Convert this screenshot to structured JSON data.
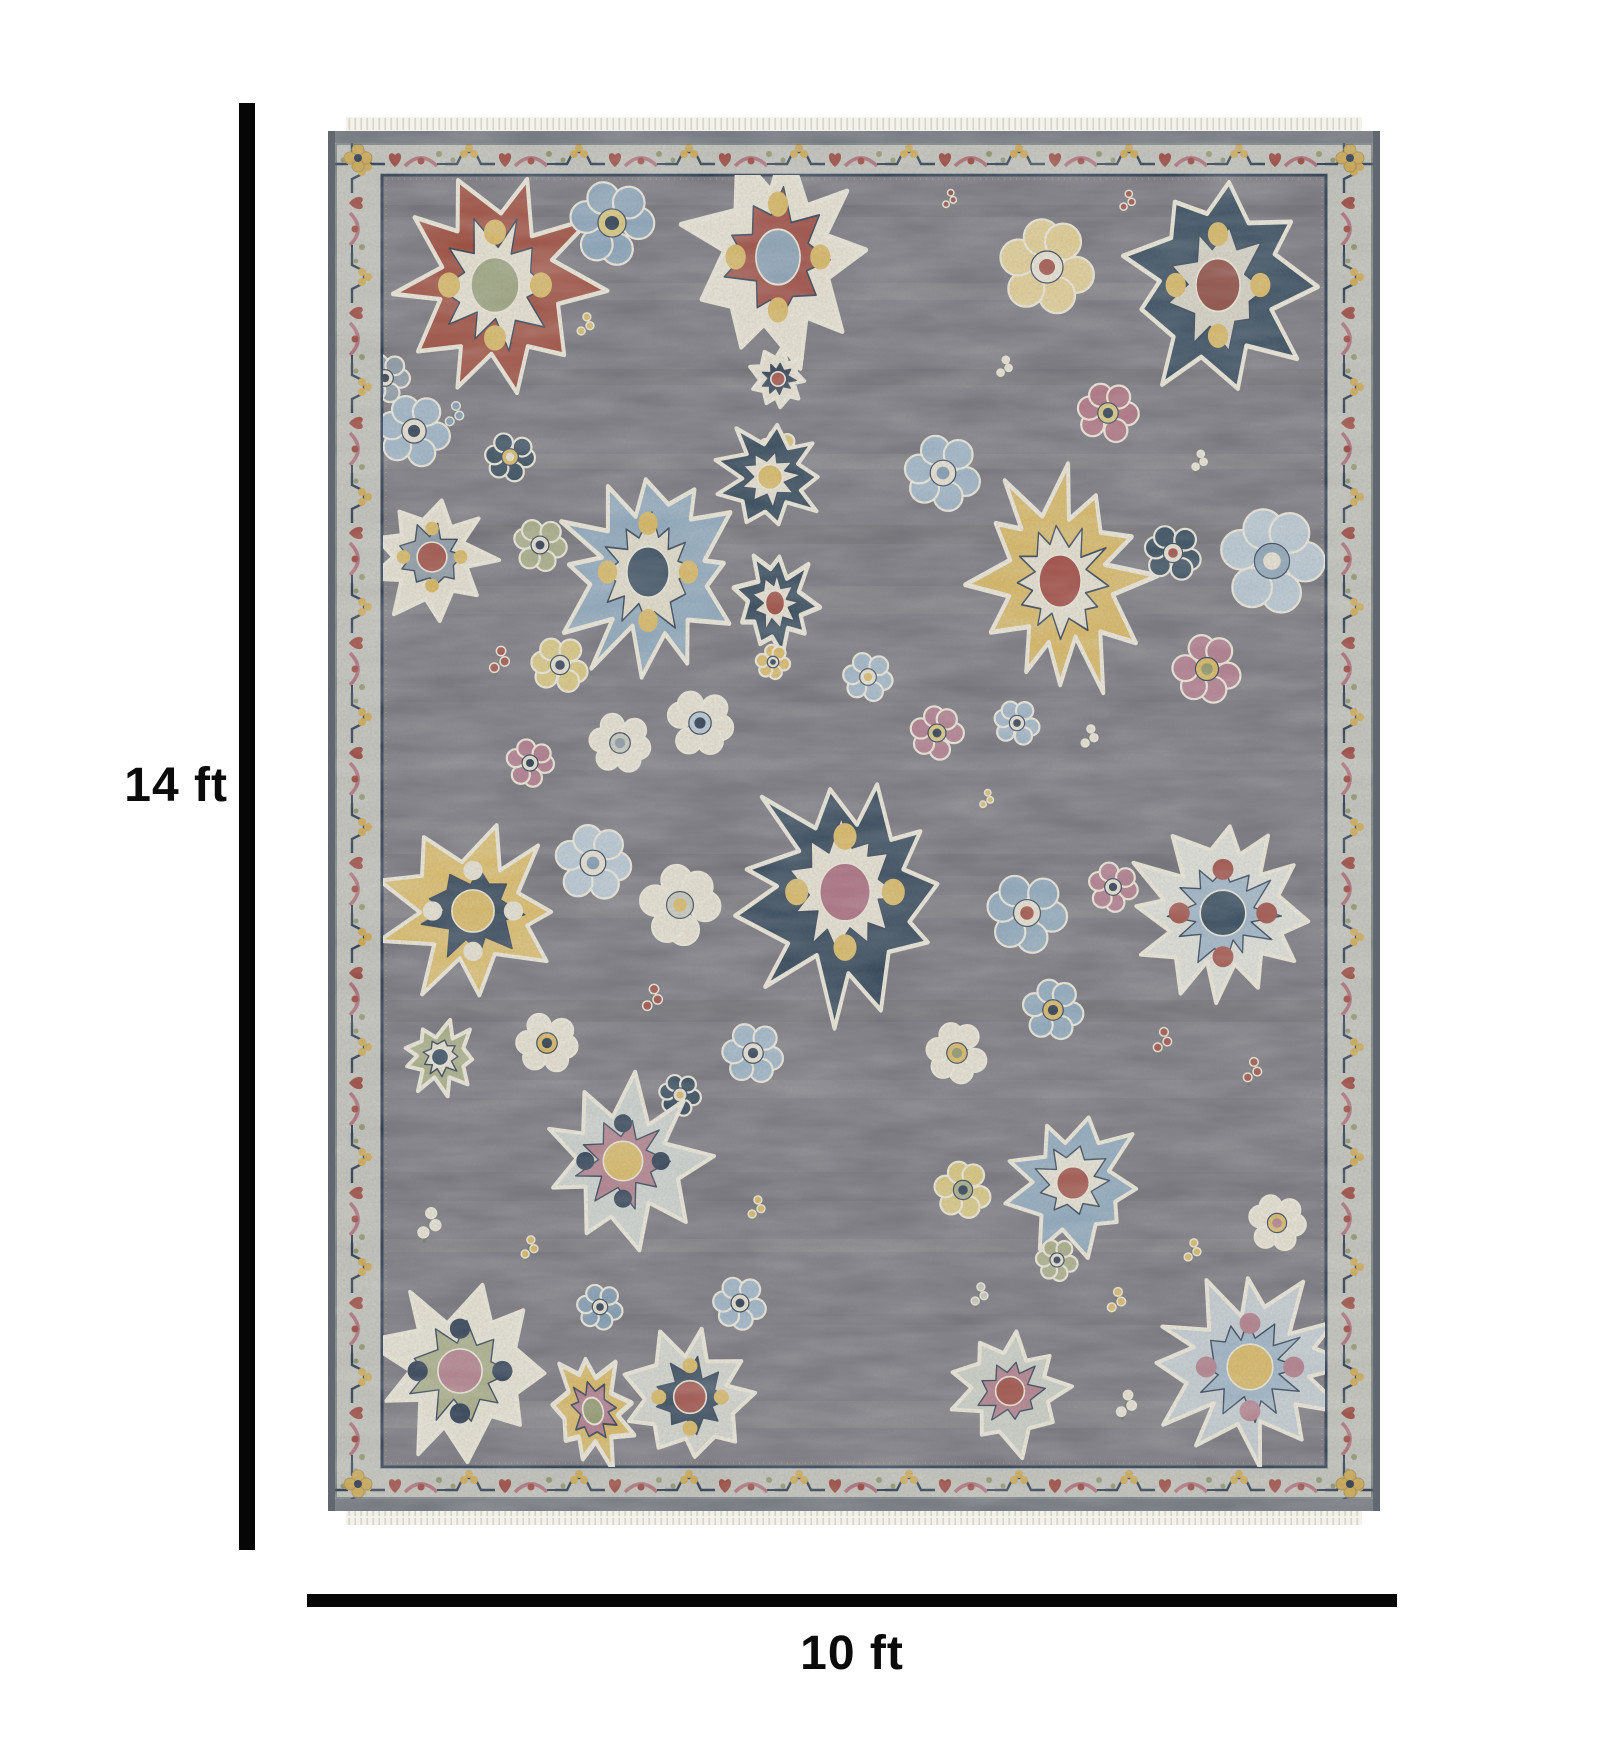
{
  "dimensions": {
    "height_label": "14 ft",
    "width_label": "10 ft"
  },
  "dimension_line_color": "#060606",
  "rug": {
    "fringe_color": "#f4f2ec",
    "fringe_tooth_color": "#d8d5c8",
    "selvedge_color": "#6e747b",
    "border_band_color": "#c2c3bb",
    "border_outline_color": "#4a5560",
    "guard_line_color": "#24364c",
    "guard_pin_color": "#c9b06a",
    "field_color": "#75747b",
    "motif_outline_ivory": "#ece8d8",
    "vine_colors": {
      "navy": "#24364c",
      "gold": "#cfa94e",
      "red": "#9a4036",
      "rose": "#ae6b77",
      "sage": "#8e9668"
    },
    "motifs": [
      {
        "t": "med",
        "x": 167,
        "y": 168,
        "r": 100,
        "sy": 1.15,
        "n": 10,
        "sd": 3,
        "o": "#9e4939",
        "i": "#e8e3d1",
        "c": "#9aa27a",
        "a": "#d9b85f"
      },
      {
        "t": "flw",
        "x": 284,
        "y": 106,
        "r": 44,
        "sd": 4,
        "o": "#89a4ba",
        "i": "#d9c77a",
        "c": "#24364c"
      },
      {
        "t": "spr",
        "x": 258,
        "y": 210,
        "r": 22,
        "sd": 5,
        "o": "#d9b85f"
      },
      {
        "t": "med",
        "x": 450,
        "y": 140,
        "r": 92,
        "sy": 1.25,
        "sd": 6,
        "o": "#e9e4d3",
        "i": "#9e4a3f",
        "c": "#8ba3b6",
        "a": "#d9b85f"
      },
      {
        "t": "med",
        "x": 450,
        "y": 262,
        "r": 30,
        "sd": 7,
        "o": "#e7e2d1",
        "i": "#24364c",
        "c": "#9e4a3f"
      },
      {
        "t": "flw",
        "x": 450,
        "y": 332,
        "r": 20,
        "sd": 8,
        "o": "#d9c77a",
        "i": "#e7e2d1",
        "c": "#24364c"
      },
      {
        "t": "flw",
        "x": 719,
        "y": 150,
        "r": 50,
        "sd": 9,
        "o": "#e3cf92",
        "i": "#e9e4d4",
        "c": "#9e4a3f"
      },
      {
        "t": "spr",
        "x": 800,
        "y": 86,
        "r": 20,
        "sd": 10,
        "o": "#9d4a41"
      },
      {
        "t": "med",
        "x": 890,
        "y": 168,
        "r": 92,
        "sy": 1.2,
        "sd": 11,
        "o": "#2d4457",
        "i": "#d7d3c4",
        "c": "#8e4a3f",
        "a": "#d9b85f"
      },
      {
        "t": "spr",
        "x": 622,
        "y": 84,
        "r": 18,
        "sd": 12,
        "o": "#8e4a3f"
      },
      {
        "t": "flw",
        "x": 780,
        "y": 296,
        "r": 32,
        "sd": 13,
        "o": "#ad6c7c",
        "i": "#d9c77a",
        "c": "#24364c"
      },
      {
        "t": "spr",
        "x": 677,
        "y": 252,
        "r": 20,
        "sd": 14,
        "o": "#e7e2d1"
      },
      {
        "t": "spr",
        "x": 127,
        "y": 300,
        "r": 24,
        "sd": 15,
        "o": "#7e9ab0"
      },
      {
        "t": "flw",
        "x": 86,
        "y": 314,
        "r": 38,
        "sd": 16,
        "o": "#9db4c6",
        "i": "#e7e2d1",
        "c": "#24364c"
      },
      {
        "t": "flw",
        "x": 57,
        "y": 261,
        "r": 26,
        "sd": 74,
        "o": "#8a98a3",
        "i": "#e7e2d1",
        "c": "#24364c"
      },
      {
        "t": "flw",
        "x": 182,
        "y": 340,
        "r": 26,
        "sd": 17,
        "o": "#2d4457",
        "i": "#d9b85f",
        "c": "#e7e2d1"
      },
      {
        "t": "med",
        "x": 104,
        "y": 440,
        "r": 62,
        "sd": 18,
        "o": "#e6e1d0",
        "i": "#8a98a3",
        "c": "#9e4a3f",
        "a": "#d9b85f"
      },
      {
        "t": "flw",
        "x": 212,
        "y": 428,
        "r": 28,
        "sd": 19,
        "o": "#a8ad85",
        "i": "#e7e2d1",
        "c": "#24364c"
      },
      {
        "t": "med",
        "x": 320,
        "y": 455,
        "r": 88,
        "sy": 1.2,
        "n": 12,
        "sd": 20,
        "o": "#8da8bc",
        "i": "#e2ddc9",
        "c": "#2d4457",
        "a": "#d9b85f"
      },
      {
        "t": "med",
        "x": 442,
        "y": 360,
        "r": 52,
        "sd": 21,
        "o": "#2c4254",
        "i": "#e7e2d0",
        "c": "#d9b85f"
      },
      {
        "t": "med",
        "x": 447,
        "y": 486,
        "r": 40,
        "sy": 1.3,
        "sd": 22,
        "o": "#2c4254",
        "i": "#e7e2d1",
        "c": "#9e4a3f"
      },
      {
        "t": "med",
        "x": 732,
        "y": 464,
        "r": 88,
        "sy": 1.25,
        "n": 12,
        "sd": 23,
        "o": "#d9b860",
        "i": "#e6e1cf",
        "c": "#9d4036"
      },
      {
        "t": "flw",
        "x": 615,
        "y": 356,
        "r": 40,
        "sd": 24,
        "o": "#9db4c6",
        "i": "#e7e2d1",
        "c": "#7e9ab0"
      },
      {
        "t": "flw",
        "x": 845,
        "y": 436,
        "r": 30,
        "sd": 25,
        "o": "#2d4457",
        "i": "#e7e2d1",
        "c": "#9e4a3f"
      },
      {
        "t": "flw",
        "x": 944,
        "y": 444,
        "r": 55,
        "sd": 26,
        "o": "#b9c9d4",
        "i": "#8aa3b6",
        "c": "#e7e2d1"
      },
      {
        "t": "spr",
        "x": 872,
        "y": 346,
        "r": 20,
        "sd": 27,
        "o": "#e7e2d1"
      },
      {
        "t": "spr",
        "x": 172,
        "y": 546,
        "r": 26,
        "sd": 28,
        "o": "#9e4a3f"
      },
      {
        "t": "flw",
        "x": 232,
        "y": 548,
        "r": 30,
        "sd": 29,
        "o": "#d9c77a",
        "i": "#e7e2d1",
        "c": "#24364c"
      },
      {
        "t": "flw",
        "x": 292,
        "y": 626,
        "r": 32,
        "sd": 30,
        "o": "#e7e2d1",
        "i": "#c6c9bd",
        "c": "#8a98a3"
      },
      {
        "t": "flw",
        "x": 372,
        "y": 606,
        "r": 35,
        "sd": 31,
        "o": "#e7e2d1",
        "i": "#b9c9d4",
        "c": "#24364c"
      },
      {
        "t": "flw",
        "x": 202,
        "y": 646,
        "r": 25,
        "sd": 32,
        "o": "#b0798a",
        "i": "#e7e2d1",
        "c": "#24364c"
      },
      {
        "t": "flw",
        "x": 609,
        "y": 616,
        "r": 28,
        "sd": 33,
        "o": "#b0798a",
        "i": "#d9c77a",
        "c": "#24364c"
      },
      {
        "t": "flw",
        "x": 879,
        "y": 552,
        "r": 36,
        "sd": 34,
        "o": "#b0798a",
        "i": "#d9b85f",
        "c": "#8e9668"
      },
      {
        "t": "spr",
        "x": 762,
        "y": 622,
        "r": 22,
        "sd": 35,
        "o": "#e7e2d1"
      },
      {
        "t": "flw",
        "x": 689,
        "y": 606,
        "r": 24,
        "sd": 36,
        "o": "#9db4c6",
        "i": "#e7e2d1",
        "c": "#24364c"
      },
      {
        "t": "flw",
        "x": 540,
        "y": 560,
        "r": 26,
        "sd": 75,
        "o": "#9db4c6",
        "i": "#e7e2d1",
        "c": "#d9b85f"
      },
      {
        "t": "med",
        "x": 145,
        "y": 794,
        "r": 88,
        "sd": 37,
        "o": "#ddbd66",
        "i": "#2d4154",
        "c": "#d9b85f",
        "a": "#e7e2d1"
      },
      {
        "t": "flw",
        "x": 265,
        "y": 746,
        "r": 40,
        "sd": 38,
        "o": "#b9c9d4",
        "i": "#e7e2d1",
        "c": "#7e9ab0"
      },
      {
        "t": "flw",
        "x": 352,
        "y": 788,
        "r": 42,
        "sd": 39,
        "o": "#e7e2d1",
        "i": "#c6c9bd",
        "c": "#d9b85f"
      },
      {
        "t": "med",
        "x": 517,
        "y": 775,
        "r": 105,
        "sy": 1.15,
        "n": 11,
        "sd": 40,
        "o": "#2c4154",
        "i": "#e7e2d1",
        "c": "#a8677a",
        "a": "#d9b85f"
      },
      {
        "t": "flw",
        "x": 445,
        "y": 545,
        "r": 18,
        "sd": 41,
        "o": "#d9b85f",
        "i": "#e7e2d1",
        "c": "#24364c"
      },
      {
        "t": "spr",
        "x": 325,
        "y": 884,
        "r": 26,
        "sd": 42,
        "o": "#9e4a3f"
      },
      {
        "t": "flw",
        "x": 699,
        "y": 796,
        "r": 42,
        "sd": 43,
        "o": "#8da8bc",
        "i": "#e7e2d1",
        "c": "#9e4a3f"
      },
      {
        "t": "flw",
        "x": 785,
        "y": 770,
        "r": 26,
        "sd": 44,
        "o": "#b0798a",
        "i": "#e7e2d1",
        "c": "#24364c"
      },
      {
        "t": "med",
        "x": 895,
        "y": 796,
        "r": 95,
        "n": 12,
        "sd": 45,
        "o": "#dfe0d8",
        "i": "#9db4c6",
        "c": "#2d4457",
        "a": "#9e4a3f"
      },
      {
        "t": "spr",
        "x": 659,
        "y": 684,
        "r": 18,
        "sd": 46,
        "o": "#d9b85f"
      },
      {
        "t": "flw",
        "x": 219,
        "y": 926,
        "r": 32,
        "sd": 47,
        "o": "#e7e2d1",
        "i": "#d9b85f",
        "c": "#24364c"
      },
      {
        "t": "med",
        "x": 112,
        "y": 940,
        "r": 36,
        "sd": 48,
        "o": "#a8ad85",
        "i": "#e7e2d1",
        "c": "#2d4457"
      },
      {
        "t": "flw",
        "x": 425,
        "y": 936,
        "r": 32,
        "sd": 49,
        "o": "#9db4c6",
        "i": "#e7e2d1",
        "c": "#24364c"
      },
      {
        "t": "flw",
        "x": 725,
        "y": 893,
        "r": 32,
        "sd": 50,
        "o": "#8da8bc",
        "i": "#d9b85f",
        "c": "#24364c"
      },
      {
        "t": "flw",
        "x": 629,
        "y": 936,
        "r": 32,
        "sd": 51,
        "o": "#e7e2d1",
        "i": "#d9b85f",
        "c": "#8e9668"
      },
      {
        "t": "spr",
        "x": 835,
        "y": 926,
        "r": 24,
        "sd": 52,
        "o": "#9e4a3f"
      },
      {
        "t": "spr",
        "x": 925,
        "y": 956,
        "r": 24,
        "sd": 53,
        "o": "#9e4a3f"
      },
      {
        "t": "flw",
        "x": 352,
        "y": 978,
        "r": 22,
        "sd": 54,
        "o": "#2d4457",
        "i": "#e7e2d1",
        "c": "#d9b85f"
      },
      {
        "t": "med",
        "x": 295,
        "y": 1044,
        "r": 82,
        "sd": 55,
        "o": "#ccd3cd",
        "i": "#b07c88",
        "c": "#d9b85f",
        "a": "#24364c"
      },
      {
        "t": "flw",
        "x": 272,
        "y": 1190,
        "r": 24,
        "sd": 56,
        "o": "#7e9ab0",
        "i": "#e7e2d1",
        "c": "#24364c"
      },
      {
        "t": "flw",
        "x": 412,
        "y": 1186,
        "r": 28,
        "sd": 57,
        "o": "#9db4c6",
        "i": "#e7e2d1",
        "c": "#24364c"
      },
      {
        "t": "spr",
        "x": 429,
        "y": 1093,
        "r": 22,
        "sd": 58,
        "o": "#d9b85f"
      },
      {
        "t": "spr",
        "x": 102,
        "y": 1110,
        "r": 30,
        "sd": 59,
        "o": "#e7e2d1"
      },
      {
        "t": "spr",
        "x": 202,
        "y": 1133,
        "r": 22,
        "sd": 60,
        "o": "#d9b85f"
      },
      {
        "t": "med",
        "x": 745,
        "y": 1066,
        "r": 68,
        "sd": 61,
        "o": "#8da8bc",
        "i": "#e6e2d2",
        "c": "#9e4a3f"
      },
      {
        "t": "flw",
        "x": 635,
        "y": 1073,
        "r": 30,
        "sd": 62,
        "o": "#d9c77a",
        "i": "#a8ad85",
        "c": "#24364c"
      },
      {
        "t": "flw",
        "x": 949,
        "y": 1106,
        "r": 30,
        "sd": 63,
        "o": "#e7e2d1",
        "i": "#d9b85f",
        "c": "#b0798a"
      },
      {
        "t": "spr",
        "x": 865,
        "y": 1136,
        "r": 22,
        "sd": 64,
        "o": "#d9b85f"
      },
      {
        "t": "flw",
        "x": 729,
        "y": 1143,
        "r": 22,
        "sd": 65,
        "o": "#a8ad85",
        "i": "#e7e2d1",
        "c": "#24364c"
      },
      {
        "t": "spr",
        "x": 789,
        "y": 1186,
        "r": 24,
        "sd": 66,
        "o": "#d9b85f"
      },
      {
        "t": "med",
        "x": 132,
        "y": 1254,
        "r": 92,
        "sd": 67,
        "o": "#e8e4d4",
        "i": "#a8ad85",
        "c": "#b07c88",
        "a": "#24364c"
      },
      {
        "t": "med",
        "x": 362,
        "y": 1280,
        "r": 68,
        "sd": 68,
        "o": "#d3d5cd",
        "i": "#2e4356",
        "c": "#9e4a3f",
        "a": "#d9b85f"
      },
      {
        "t": "med",
        "x": 265,
        "y": 1294,
        "r": 42,
        "sy": 1.35,
        "ro": -15,
        "sd": 69,
        "o": "#d9b860",
        "i": "#b0798a",
        "c": "#8e9668"
      },
      {
        "t": "med",
        "x": 682,
        "y": 1274,
        "r": 60,
        "sd": 70,
        "o": "#c9cfc4",
        "i": "#b07c88",
        "c": "#9e4a3f"
      },
      {
        "t": "spr",
        "x": 799,
        "y": 1290,
        "r": 26,
        "sd": 71,
        "o": "#e7e2d1"
      },
      {
        "t": "med",
        "x": 922,
        "y": 1250,
        "r": 95,
        "n": 12,
        "sd": 72,
        "o": "#c3cdd2",
        "i": "#9db4c6",
        "c": "#d9b860",
        "a": "#b07c88"
      },
      {
        "t": "spr",
        "x": 652,
        "y": 1180,
        "r": 22,
        "sd": 73,
        "o": "#c6c9bd"
      }
    ]
  }
}
